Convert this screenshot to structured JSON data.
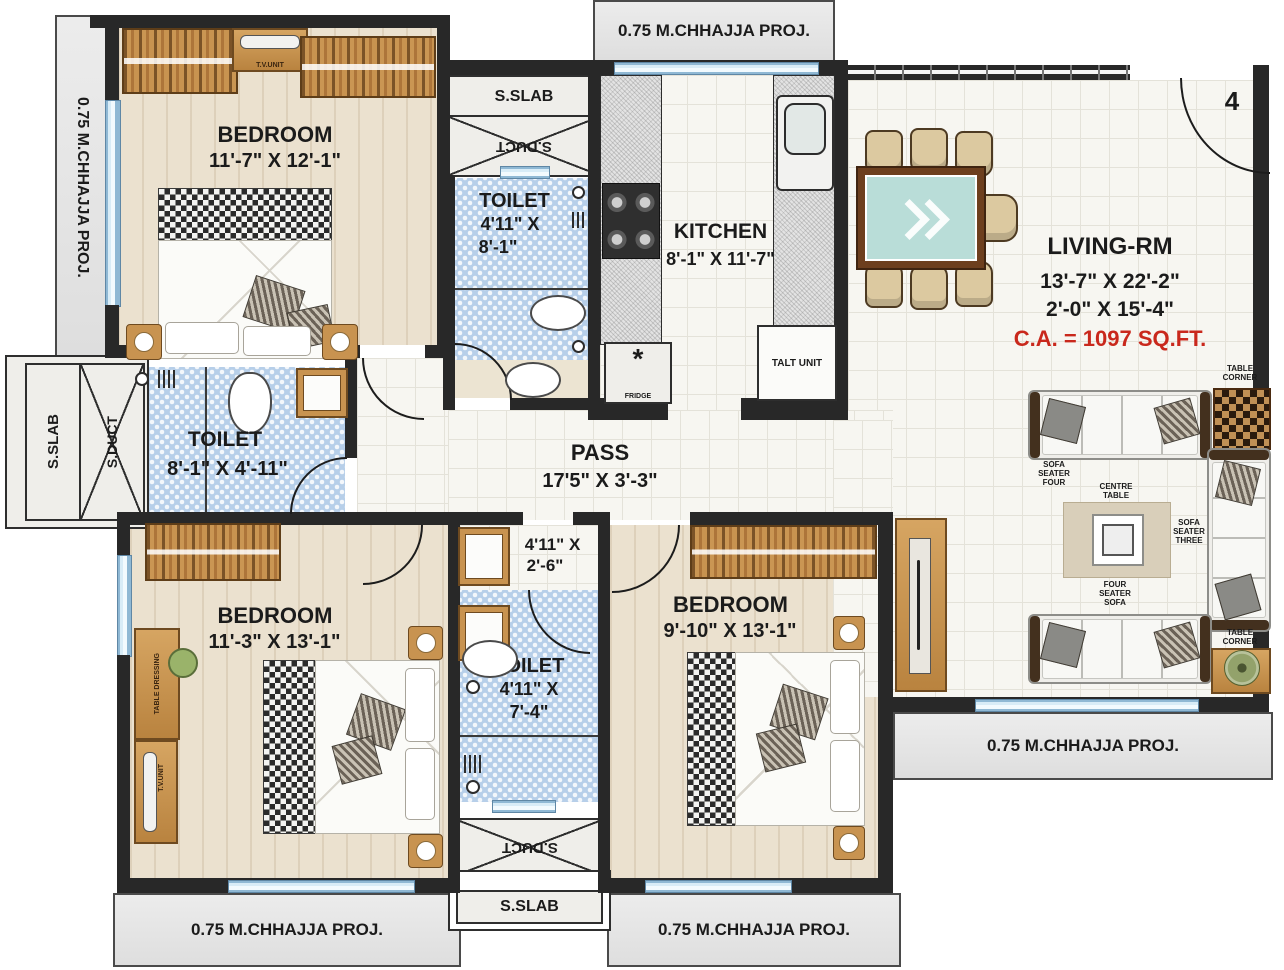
{
  "unit": {
    "number": "4"
  },
  "labels": {
    "chhajja": "0.75 M.CHHAJJA PROJ.",
    "sslab": "S.SLAB",
    "sduct": "S.DUCT",
    "tv_unit": "T.V.UNIT",
    "table_dressing": "TABLE DRESSING",
    "talt_unit": "TALT UNIT",
    "fridge": "FRIDGE"
  },
  "rooms": {
    "bedroom1": {
      "name": "BEDROOM",
      "dims": "11'-7\" X 12'-1\""
    },
    "bedroom2": {
      "name": "BEDROOM",
      "dims": "11'-3\" X 13'-1\""
    },
    "bedroom3": {
      "name": "BEDROOM",
      "dims": "9'-10\" X 13'-1\""
    },
    "toilet_top": {
      "name": "TOILET",
      "dim_a": "4'11\" X",
      "dim_b": "8'-1\""
    },
    "toilet_left": {
      "name": "TOILET",
      "dims": "8'-1\" X 4'-11\""
    },
    "toilet_bottom": {
      "name": "TOILET",
      "dim_a": "4'11\" X",
      "dim_b": "7'-4\""
    },
    "toilet_lobby": {
      "dim_a": "4'11\" X",
      "dim_b": "2'-6\""
    },
    "kitchen": {
      "name": "KITCHEN",
      "dims": "8'-1\" X 11'-7\""
    },
    "living": {
      "name": "LIVING-RM",
      "dims1": "13'-7\" X 22'-2\"",
      "dims2": "2'-0\" X 15'-4\"",
      "area": "C.A. = 1097 SQ.FT."
    },
    "pass": {
      "name": "PASS",
      "dims": "17'5\" X 3'-3\""
    }
  },
  "furniture": {
    "sofa_four": "SOFA SEATER FOUR",
    "sofa_three": "SOFA SEATER THREE",
    "four_seater": "FOUR SEATER SOFA",
    "centre_table": "CENTRE TABLE",
    "table_corner": "TABLE CORNER"
  },
  "colors": {
    "wall": "#282828",
    "accent_red": "#c9281c",
    "toilet_blue": "#b7cfe9",
    "window_blue": "#d8ecf7",
    "wood": "#c89350"
  }
}
